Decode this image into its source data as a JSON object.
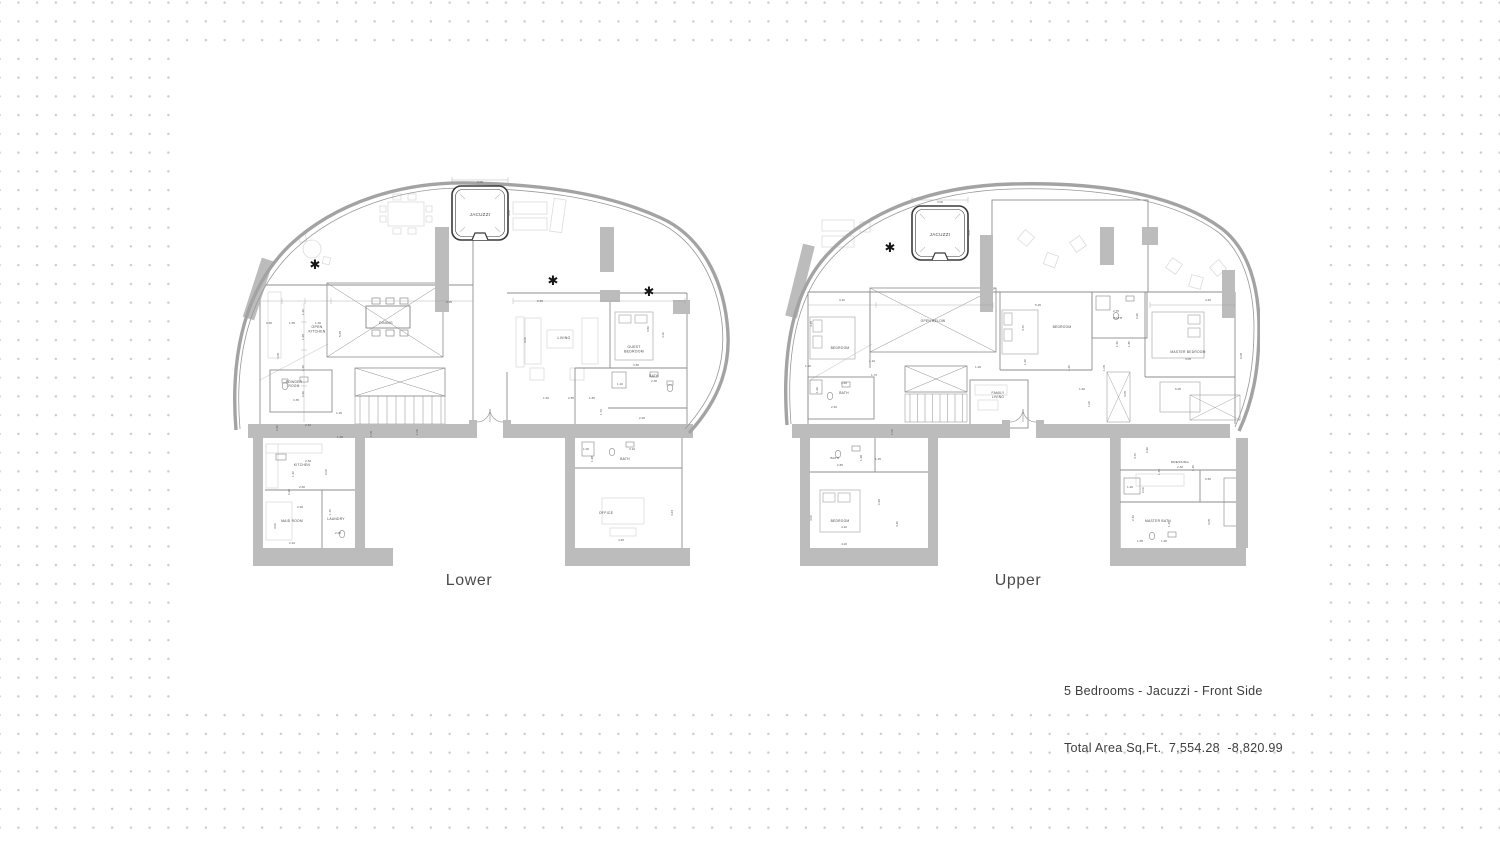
{
  "annotation": {
    "line1": "5 Bedrooms - Jacuzzi - Front Side",
    "line2": "Total Area Sq.Ft.  7,554.28  -8,820.99"
  },
  "symbols": {
    "star": "✱"
  },
  "colors": {
    "wall_gray": "#bcbcbc",
    "outline_gray": "#a3a3a3",
    "dot_gray": "#cbcbcb",
    "label_text": "#474747",
    "dim_text": "#5c5c5c",
    "caption_text": "#4b4b4b"
  },
  "plans": [
    {
      "caption": "Lower",
      "texts": [
        {
          "k": "label",
          "t": "JACUZZI",
          "x": 250,
          "y": 44,
          "fs": 4.6
        },
        {
          "k": "label",
          "t": "OPEN\nKITCHEN",
          "x": 87,
          "y": 156,
          "fs": 3.5
        },
        {
          "k": "label",
          "t": "DINING",
          "x": 156,
          "y": 152,
          "fs": 3.5
        },
        {
          "k": "label",
          "t": "LIVING",
          "x": 334,
          "y": 167,
          "fs": 3.5
        },
        {
          "k": "label",
          "t": "GUEST\nBEDROOM",
          "x": 404,
          "y": 176,
          "fs": 3.5
        },
        {
          "k": "label",
          "t": "POWDER\nROOM",
          "x": 64,
          "y": 211,
          "fs": 3.3
        },
        {
          "k": "label",
          "t": "BATH",
          "x": 424,
          "y": 205,
          "fs": 3.3
        },
        {
          "k": "label",
          "t": "KITCHEN",
          "x": 72,
          "y": 294,
          "fs": 3.3
        },
        {
          "k": "label",
          "t": "MAID ROOM",
          "x": 62,
          "y": 350,
          "fs": 3.3
        },
        {
          "k": "label",
          "t": "LAUNDRY",
          "x": 106,
          "y": 348,
          "fs": 3.3
        },
        {
          "k": "label",
          "t": "BATH",
          "x": 395,
          "y": 288,
          "fs": 3.3
        },
        {
          "k": "label",
          "t": "OFFICE",
          "x": 376,
          "y": 342,
          "fs": 3.5
        },
        {
          "k": "dim",
          "t": "3.00",
          "x": 250,
          "y": 11
        },
        {
          "k": "dim",
          "t": "3.00",
          "x": 280,
          "y": 41,
          "r": -90
        },
        {
          "k": "dim",
          "t": "0.65",
          "x": 39,
          "y": 152
        },
        {
          "k": "dim",
          "t": "1.55",
          "x": 62,
          "y": 152
        },
        {
          "k": "dim",
          "t": "1.30",
          "x": 88,
          "y": 152
        },
        {
          "k": "dim",
          "t": "4.05",
          "x": 49,
          "y": 184,
          "r": -90
        },
        {
          "k": "dim",
          "t": "1.20",
          "x": 74,
          "y": 140,
          "r": -90
        },
        {
          "k": "dim",
          "t": "1.65",
          "x": 74,
          "y": 165,
          "r": -90
        },
        {
          "k": "dim",
          "t": "5.25",
          "x": 111,
          "y": 162,
          "r": -90
        },
        {
          "k": "dim",
          "t": "1.20",
          "x": 74,
          "y": 196,
          "r": -90
        },
        {
          "k": "dim",
          "t": "0.60",
          "x": 74,
          "y": 222,
          "r": -90
        },
        {
          "k": "dim",
          "t": "0.95",
          "x": 219,
          "y": 131
        },
        {
          "k": "dim",
          "t": "8.65",
          "x": 310,
          "y": 130
        },
        {
          "k": "dim",
          "t": "9.00",
          "x": 296,
          "y": 168,
          "r": -90
        },
        {
          "k": "dim",
          "t": "3.50",
          "x": 419,
          "y": 157,
          "r": -90
        },
        {
          "k": "dim",
          "t": "4.10",
          "x": 434,
          "y": 163,
          "r": -90
        },
        {
          "k": "dim",
          "t": "3.50",
          "x": 406,
          "y": 194
        },
        {
          "k": "dim",
          "t": "1.10",
          "x": 390,
          "y": 213
        },
        {
          "k": "dim",
          "t": "2.30",
          "x": 424,
          "y": 210
        },
        {
          "k": "dim",
          "t": "1.60",
          "x": 316,
          "y": 227
        },
        {
          "k": "dim",
          "t": "2.65",
          "x": 341,
          "y": 227
        },
        {
          "k": "dim",
          "t": "1.80",
          "x": 362,
          "y": 227
        },
        {
          "k": "dim",
          "t": "1.72",
          "x": 372,
          "y": 240,
          "r": -90
        },
        {
          "k": "dim",
          "t": "2.20",
          "x": 412,
          "y": 247
        },
        {
          "k": "dim",
          "t": "3.35",
          "x": 66,
          "y": 229
        },
        {
          "k": "dim",
          "t": "2.40",
          "x": 78,
          "y": 254
        },
        {
          "k": "dim",
          "t": "0.60",
          "x": 48,
          "y": 256,
          "r": -90
        },
        {
          "k": "dim",
          "t": "1.25",
          "x": 109,
          "y": 242
        },
        {
          "k": "dim",
          "t": "1.28",
          "x": 110,
          "y": 266
        },
        {
          "k": "dim",
          "t": "1.05",
          "x": 142,
          "y": 262,
          "r": -90
        },
        {
          "k": "dim",
          "t": "1.00",
          "x": 188,
          "y": 260,
          "r": -90
        },
        {
          "k": "dim",
          "t": "2.36",
          "x": 78,
          "y": 290
        },
        {
          "k": "dim",
          "t": "1.40",
          "x": 64,
          "y": 302,
          "r": -90
        },
        {
          "k": "dim",
          "t": "0.90",
          "x": 60,
          "y": 320,
          "r": -90
        },
        {
          "k": "dim",
          "t": "2.00",
          "x": 97,
          "y": 300,
          "r": -90
        },
        {
          "k": "dim",
          "t": "2.60",
          "x": 72,
          "y": 316
        },
        {
          "k": "dim",
          "t": "2.90",
          "x": 70,
          "y": 336
        },
        {
          "k": "dim",
          "t": "1.70",
          "x": 101,
          "y": 340,
          "r": -90
        },
        {
          "k": "dim",
          "t": "3.00",
          "x": 46,
          "y": 354,
          "r": -90
        },
        {
          "k": "dim",
          "t": "2.08",
          "x": 108,
          "y": 362
        },
        {
          "k": "dim",
          "t": "2.10",
          "x": 62,
          "y": 372
        },
        {
          "k": "dim",
          "t": "1.98",
          "x": 363,
          "y": 287,
          "r": -90
        },
        {
          "k": "dim",
          "t": "3.10",
          "x": 402,
          "y": 278
        },
        {
          "k": "dim",
          "t": "1.00",
          "x": 356,
          "y": 278
        },
        {
          "k": "dim",
          "t": "4.23",
          "x": 443,
          "y": 341,
          "r": -90
        },
        {
          "k": "dim",
          "t": "4.45",
          "x": 391,
          "y": 369
        }
      ],
      "stars": [
        {
          "x": 85,
          "y": 97
        },
        {
          "x": 323,
          "y": 113
        },
        {
          "x": 419,
          "y": 124
        }
      ]
    },
    {
      "caption": "Upper",
      "texts": [
        {
          "k": "label",
          "t": "JACUZZI",
          "x": 160,
          "y": 64,
          "fs": 4.6
        },
        {
          "k": "label",
          "t": "BEDROOM",
          "x": 60,
          "y": 177,
          "fs": 3.3
        },
        {
          "k": "label",
          "t": "OPEN BELOW",
          "x": 153,
          "y": 150,
          "fs": 3.3
        },
        {
          "k": "label",
          "t": "BATH",
          "x": 64,
          "y": 222,
          "fs": 3.3
        },
        {
          "k": "label",
          "t": "FAMILY\nLIVING",
          "x": 218,
          "y": 222,
          "fs": 3.3
        },
        {
          "k": "label",
          "t": "BEDROOM",
          "x": 282,
          "y": 156,
          "fs": 3.3
        },
        {
          "k": "label",
          "t": "BATH",
          "x": 338,
          "y": 147,
          "fs": 3.1
        },
        {
          "k": "label",
          "t": "MASTER BEDROOM",
          "x": 408,
          "y": 181,
          "fs": 3.3
        },
        {
          "k": "label",
          "t": "BEDROOM",
          "x": 60,
          "y": 350,
          "fs": 3.3
        },
        {
          "k": "label",
          "t": "BATH",
          "x": 55,
          "y": 287,
          "fs": 3.1
        },
        {
          "k": "label",
          "t": "DRESSING",
          "x": 400,
          "y": 291,
          "fs": 3.1
        },
        {
          "k": "label",
          "t": "MASTER BATH",
          "x": 378,
          "y": 350,
          "fs": 3.3
        },
        {
          "k": "dim",
          "t": "3.00",
          "x": 160,
          "y": 31
        },
        {
          "k": "dim",
          "t": "3.00",
          "x": 190,
          "y": 61,
          "r": -90
        },
        {
          "k": "dim",
          "t": "3.40",
          "x": 62,
          "y": 129
        },
        {
          "k": "dim",
          "t": "4.25",
          "x": 32,
          "y": 152,
          "r": -90
        },
        {
          "k": "dim",
          "t": "5.25",
          "x": 258,
          "y": 134
        },
        {
          "k": "dim",
          "t": "3.70",
          "x": 244,
          "y": 156,
          "r": -90
        },
        {
          "k": "dim",
          "t": "2.75",
          "x": 336,
          "y": 140
        },
        {
          "k": "dim",
          "t": "2.90",
          "x": 358,
          "y": 144,
          "r": -90
        },
        {
          "k": "dim",
          "t": "3.40",
          "x": 428,
          "y": 129
        },
        {
          "k": "dim",
          "t": "1.60",
          "x": 338,
          "y": 172,
          "r": -90
        },
        {
          "k": "dim",
          "t": "1.80",
          "x": 350,
          "y": 172,
          "r": -90
        },
        {
          "k": "dim",
          "t": "1.05",
          "x": 325,
          "y": 196,
          "r": -90
        },
        {
          "k": "dim",
          "t": "1.20",
          "x": 290,
          "y": 196,
          "r": -90
        },
        {
          "k": "dim",
          "t": "4.05",
          "x": 408,
          "y": 188
        },
        {
          "k": "dim",
          "t": "6.08",
          "x": 462,
          "y": 184,
          "r": -90
        },
        {
          "k": "dim",
          "t": "6.05",
          "x": 398,
          "y": 218
        },
        {
          "k": "dim",
          "t": "3.05",
          "x": 346,
          "y": 222,
          "r": -90
        },
        {
          "k": "dim",
          "t": "1.60",
          "x": 302,
          "y": 218
        },
        {
          "k": "dim",
          "t": "1.00",
          "x": 310,
          "y": 232,
          "r": -90
        },
        {
          "k": "dim",
          "t": "1.20",
          "x": 246,
          "y": 190,
          "r": -90
        },
        {
          "k": "dim",
          "t": "1.20",
          "x": 198,
          "y": 196
        },
        {
          "k": "dim",
          "t": "3.40",
          "x": 64,
          "y": 212
        },
        {
          "k": "dim",
          "t": "1.90",
          "x": 38,
          "y": 218,
          "r": -90
        },
        {
          "k": "dim",
          "t": "1.10",
          "x": 92,
          "y": 190
        },
        {
          "k": "dim",
          "t": "1.73",
          "x": 94,
          "y": 204
        },
        {
          "k": "dim",
          "t": "2.40",
          "x": 54,
          "y": 236
        },
        {
          "k": "dim",
          "t": "1.20",
          "x": 28,
          "y": 195
        },
        {
          "k": "dim",
          "t": "1.00",
          "x": 113,
          "y": 260,
          "r": -90
        },
        {
          "k": "dim",
          "t": "1.25",
          "x": 98,
          "y": 288
        },
        {
          "k": "dim",
          "t": "2.80",
          "x": 60,
          "y": 294
        },
        {
          "k": "dim",
          "t": "1.98",
          "x": 82,
          "y": 286,
          "r": -90
        },
        {
          "k": "dim",
          "t": "4.00",
          "x": 32,
          "y": 346,
          "r": -90
        },
        {
          "k": "dim",
          "t": "0.65",
          "x": 100,
          "y": 330,
          "r": -90
        },
        {
          "k": "dim",
          "t": "4.20",
          "x": 64,
          "y": 356
        },
        {
          "k": "dim",
          "t": "3.40",
          "x": 118,
          "y": 352,
          "r": -90
        },
        {
          "k": "dim",
          "t": "4.20",
          "x": 64,
          "y": 373
        },
        {
          "k": "dim",
          "t": "3.70",
          "x": 356,
          "y": 284,
          "r": -90
        },
        {
          "k": "dim",
          "t": "0.60",
          "x": 368,
          "y": 278,
          "r": -90
        },
        {
          "k": "dim",
          "t": "1.40",
          "x": 380,
          "y": 300,
          "r": -90
        },
        {
          "k": "dim",
          "t": "2.40",
          "x": 414,
          "y": 296,
          "r": -90
        },
        {
          "k": "dim",
          "t": "2.30",
          "x": 400,
          "y": 296
        },
        {
          "k": "dim",
          "t": "0.60",
          "x": 428,
          "y": 308
        },
        {
          "k": "dim",
          "t": "1.20",
          "x": 350,
          "y": 316
        },
        {
          "k": "dim",
          "t": "2.00",
          "x": 364,
          "y": 318,
          "r": -90
        },
        {
          "k": "dim",
          "t": "2.40",
          "x": 354,
          "y": 346,
          "r": -90
        },
        {
          "k": "dim",
          "t": "1.40",
          "x": 390,
          "y": 352,
          "r": -90
        },
        {
          "k": "dim",
          "t": "3.05",
          "x": 430,
          "y": 350,
          "r": -90
        },
        {
          "k": "dim",
          "t": "1.55",
          "x": 360,
          "y": 370
        },
        {
          "k": "dim",
          "t": "1.90",
          "x": 384,
          "y": 370
        }
      ],
      "stars": [
        {
          "x": 110,
          "y": 80
        }
      ]
    }
  ]
}
